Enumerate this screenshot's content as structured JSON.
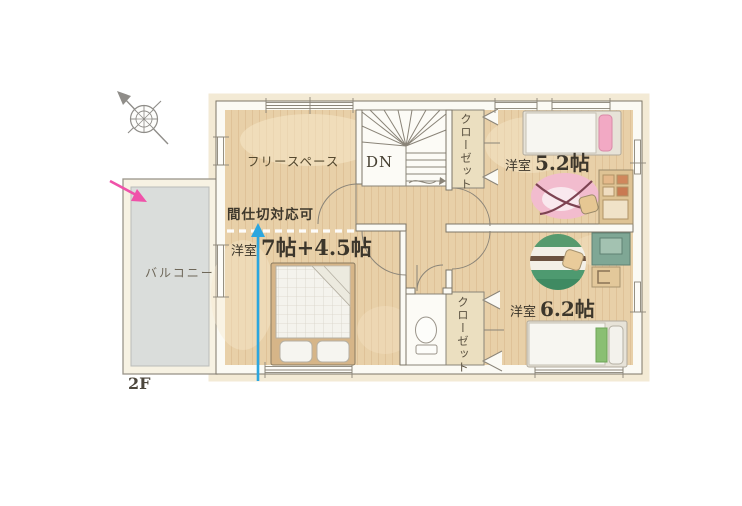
{
  "page": {
    "background": "#ffffff"
  },
  "floor_plan": {
    "floor_label": "2F",
    "rooms": {
      "free_space": {
        "label": "フリースペース"
      },
      "master_bedroom": {
        "name_label": "洋室",
        "size_label": "7帖+4.5帖",
        "partition_note": "間仕切対応可"
      },
      "bedroom_52": {
        "name_label": "洋室",
        "size_label": "5.2帖"
      },
      "bedroom_62": {
        "name_label": "洋室",
        "size_label": "6.2帖"
      },
      "closet_north": {
        "label": "クローゼット"
      },
      "closet_south": {
        "label": "クローゼット"
      },
      "balcony": {
        "label": "バルコニー"
      },
      "stairs": {
        "down_label": "DN"
      }
    },
    "colors": {
      "wood_floor": "#e8d0a8",
      "plank_line": "#d5b488",
      "wall_fill": "#fbfaf4",
      "wall_stroke": "#7d7668",
      "balcony_deck": "#dadddb",
      "closet_fill": "#ebdfc0",
      "pink_arrow": "#ef52a9",
      "blue_arrow": "#2ba6df"
    },
    "icons": {
      "compass": "compass-north-icon",
      "pink_arrow": "balcony-pointer-arrow",
      "blue_arrow": "partition-pointer-arrow"
    }
  }
}
